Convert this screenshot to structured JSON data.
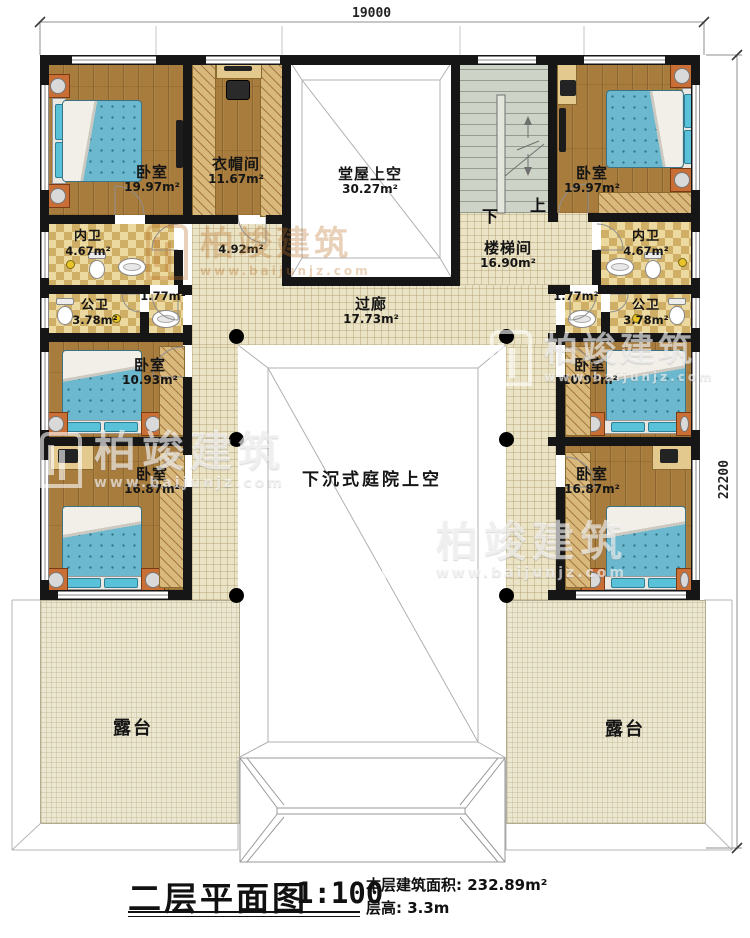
{
  "dimensions": {
    "width": "19000",
    "height": "22200"
  },
  "rooms": {
    "bedroom_tl": {
      "name": "卧室",
      "area": "19.97m²"
    },
    "cloakroom": {
      "name": "衣帽间",
      "area": "11.67m²"
    },
    "hall_void": {
      "name": "堂屋上空",
      "area": "30.27m²"
    },
    "stairwell": {
      "name": "楼梯间",
      "area": "16.90m²"
    },
    "bedroom_tr": {
      "name": "卧室",
      "area": "19.97m²"
    },
    "bath_private_left": {
      "name": "内卫",
      "area": "4.67m²"
    },
    "bath_private_right": {
      "name": "内卫",
      "area": "4.67m²"
    },
    "hall_left": {
      "area": "4.92m²"
    },
    "vestibule_left": {
      "area": "1.77m²"
    },
    "vestibule_right": {
      "area": "1.77m²"
    },
    "bath_public_left": {
      "name": "公卫",
      "area": "3.78m²"
    },
    "bath_public_right": {
      "name": "公卫",
      "area": "3.78m²"
    },
    "corridor": {
      "name": "过廊",
      "area": "17.73m²"
    },
    "bedroom_ml": {
      "name": "卧室",
      "area": "10.93m²"
    },
    "bedroom_mr": {
      "name": "卧室",
      "area": "10.93m²"
    },
    "bedroom_bl": {
      "name": "卧室",
      "area": "16.87m²"
    },
    "bedroom_br": {
      "name": "卧室",
      "area": "16.87m²"
    },
    "courtyard_void": {
      "name": "下沉式庭院上空"
    },
    "terrace_left": {
      "name": "露台"
    },
    "terrace_right": {
      "name": "露台"
    }
  },
  "stairs": {
    "down": "下",
    "up": "上"
  },
  "title": {
    "main": "二层平面图",
    "scale": "1:100",
    "area_text": "本层建筑面积: 232.89m²",
    "height_text": "层高: 3.3m"
  },
  "watermark": {
    "brand": "柏竣建筑",
    "url": "www.baijunjz.com"
  },
  "colors": {
    "wall": "#161616",
    "wood_floor": "#a87c3c",
    "tile_floor": "#ecd9a0",
    "walkway_floor": "#ebe3c6",
    "terrace_floor": "#ece7d1",
    "stair_floor": "#cdd4c7",
    "bed": "#6cb9cf",
    "nightstand": "#c96f35",
    "watermark_orange": "#ba7328"
  }
}
